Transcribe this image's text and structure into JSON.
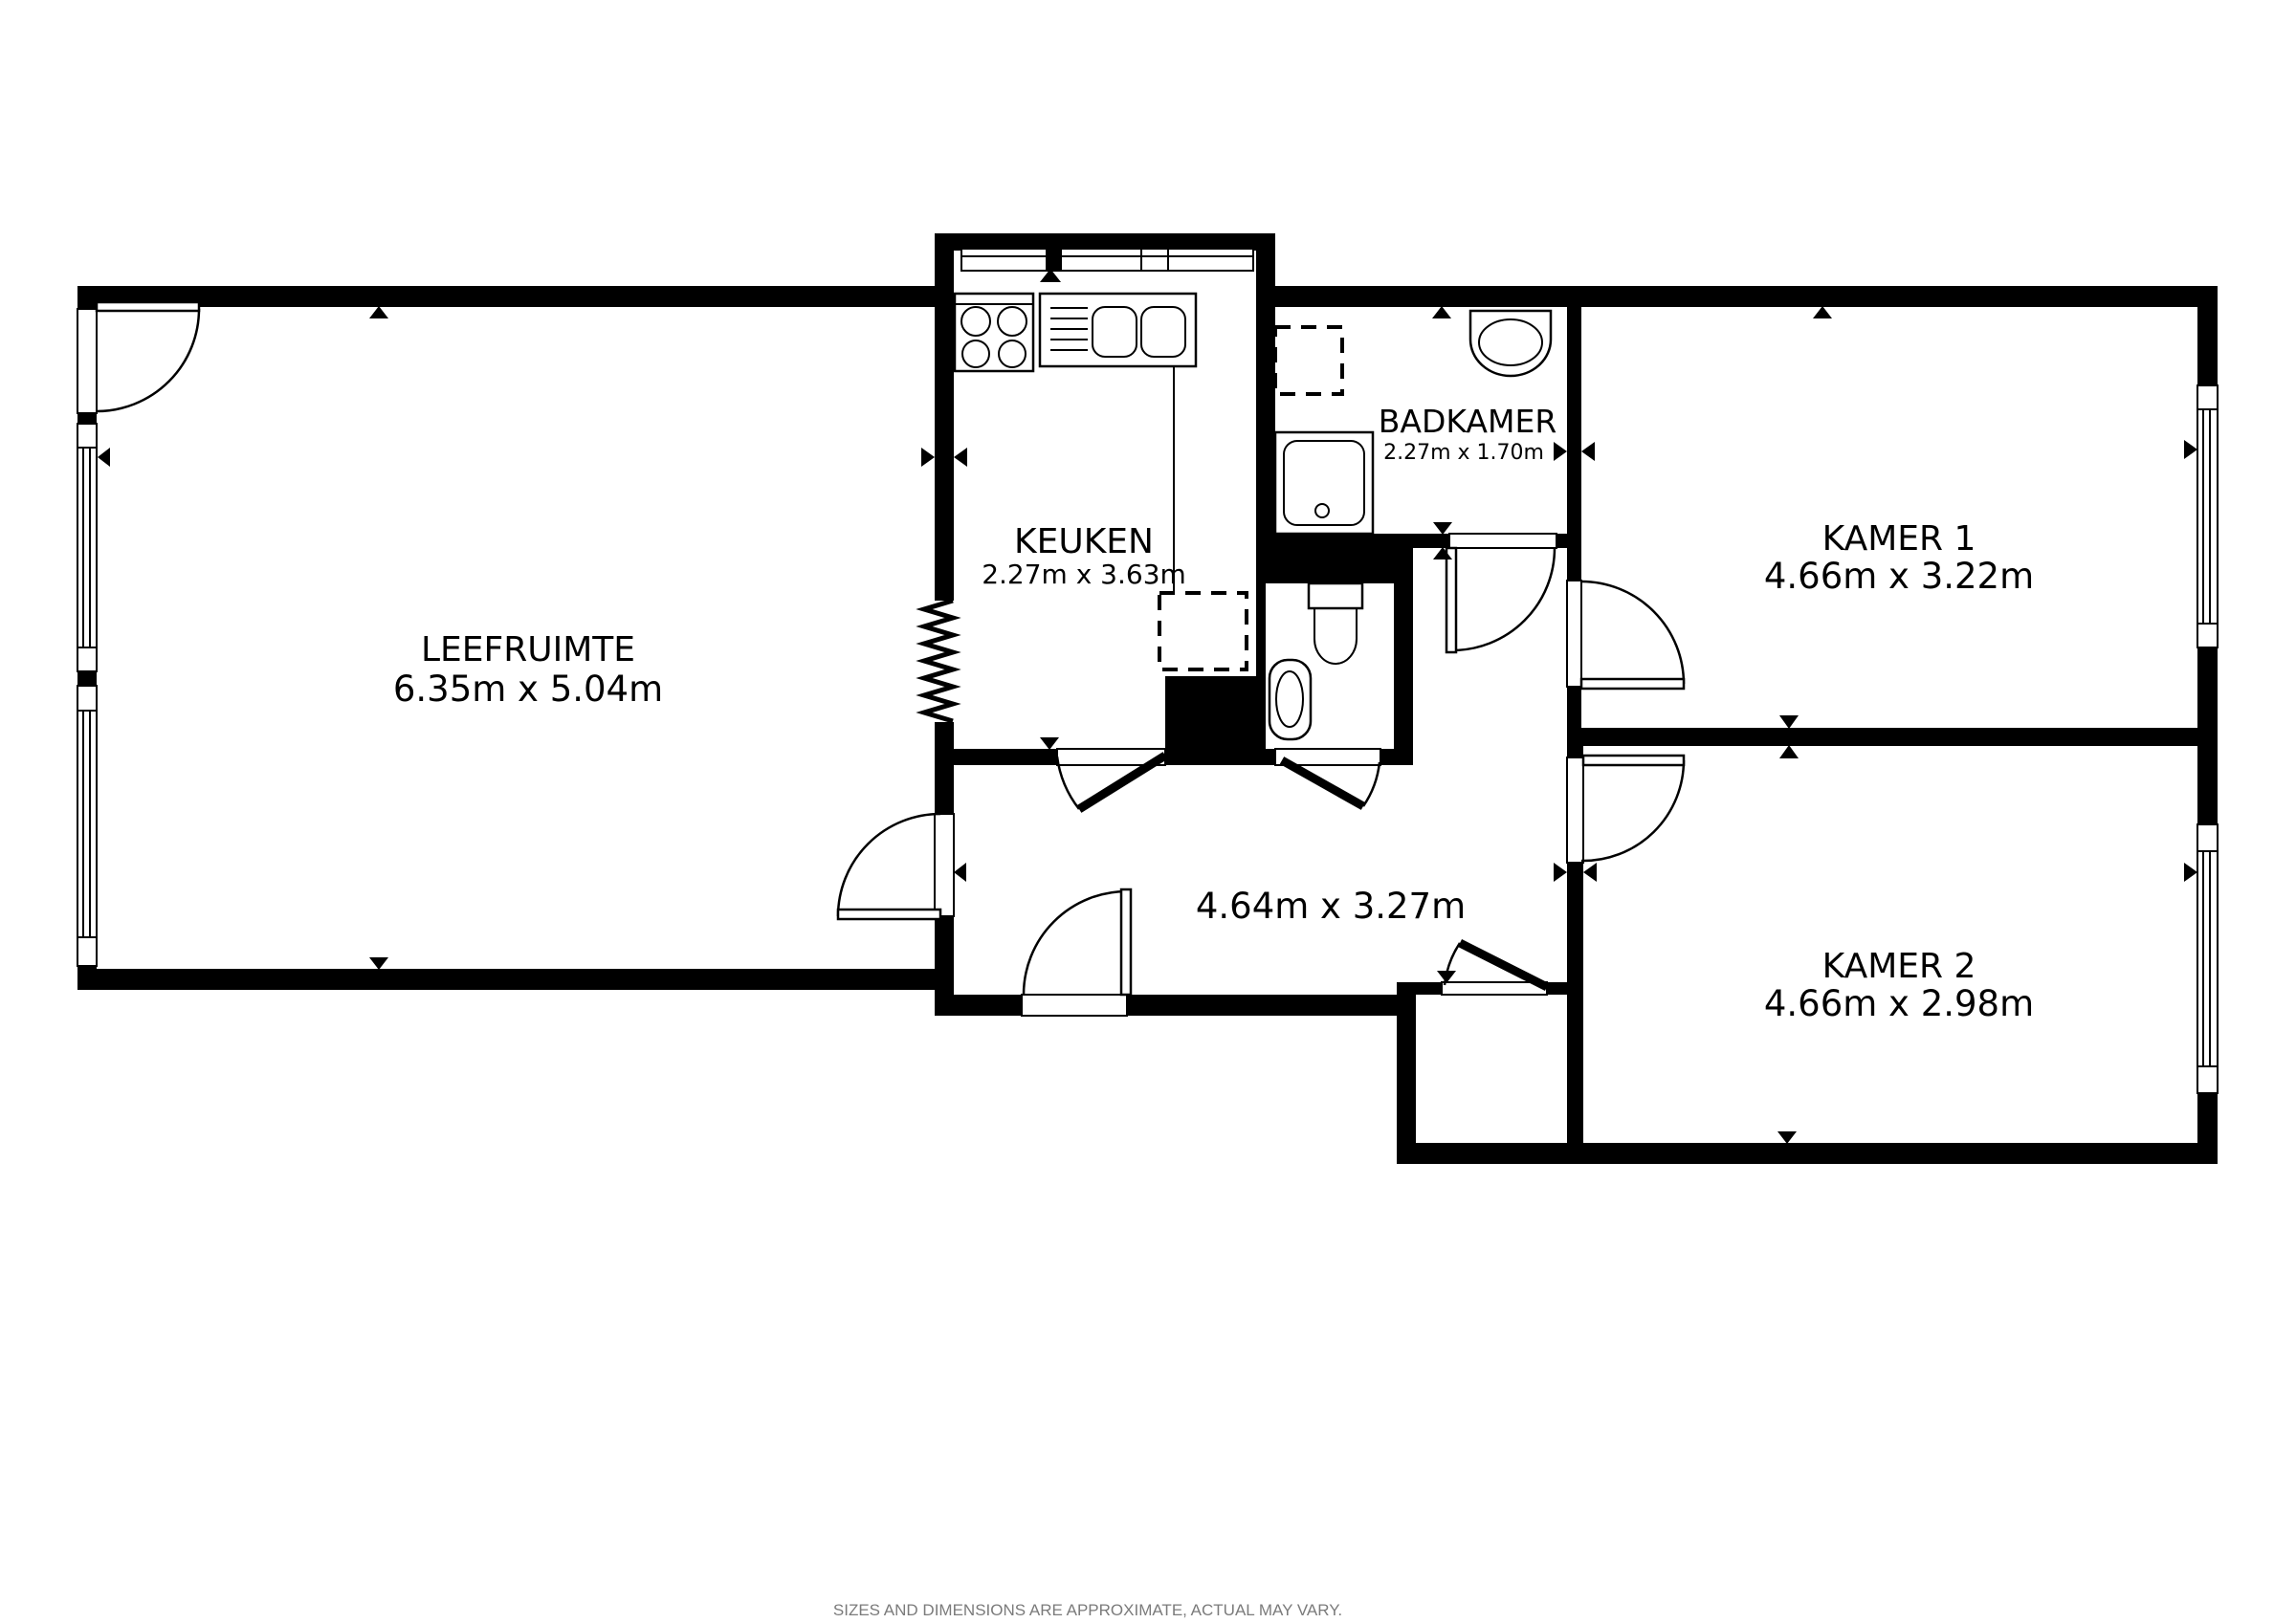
{
  "page": {
    "footer_note": "SIZES AND DIMENSIONS ARE APPROXIMATE, ACTUAL MAY VARY."
  },
  "colors": {
    "wall": "#000000",
    "background": "#ffffff",
    "footer_text": "#7b7b7b"
  },
  "rooms": {
    "leefruimte": {
      "name": "LEEFRUIMTE",
      "dimensions": "6.35m x 5.04m"
    },
    "keuken": {
      "name": "KEUKEN",
      "dimensions": "2.27m x 3.63m"
    },
    "badkamer": {
      "name": "BADKAMER",
      "dimensions": "2.27m x 1.70m"
    },
    "hal": {
      "dimensions": "4.64m x 3.27m"
    },
    "kamer1": {
      "name": "KAMER 1",
      "dimensions": "4.66m x 3.22m"
    },
    "kamer2": {
      "name": "KAMER 2",
      "dimensions": "4.66m x 2.98m"
    }
  },
  "fixtures": {
    "stove": "4-burner stove",
    "sink": "double kitchen sink with drainer",
    "shower": "shower tray with drain",
    "washer_bathroom": "appliance position (dashed)",
    "washer_kitchen": "appliance position (dashed)",
    "bath_basin": "wash basin",
    "toilet": "toilet with cistern",
    "wc_basin": "hand basin",
    "radiator": "zigzag radiator symbol"
  }
}
